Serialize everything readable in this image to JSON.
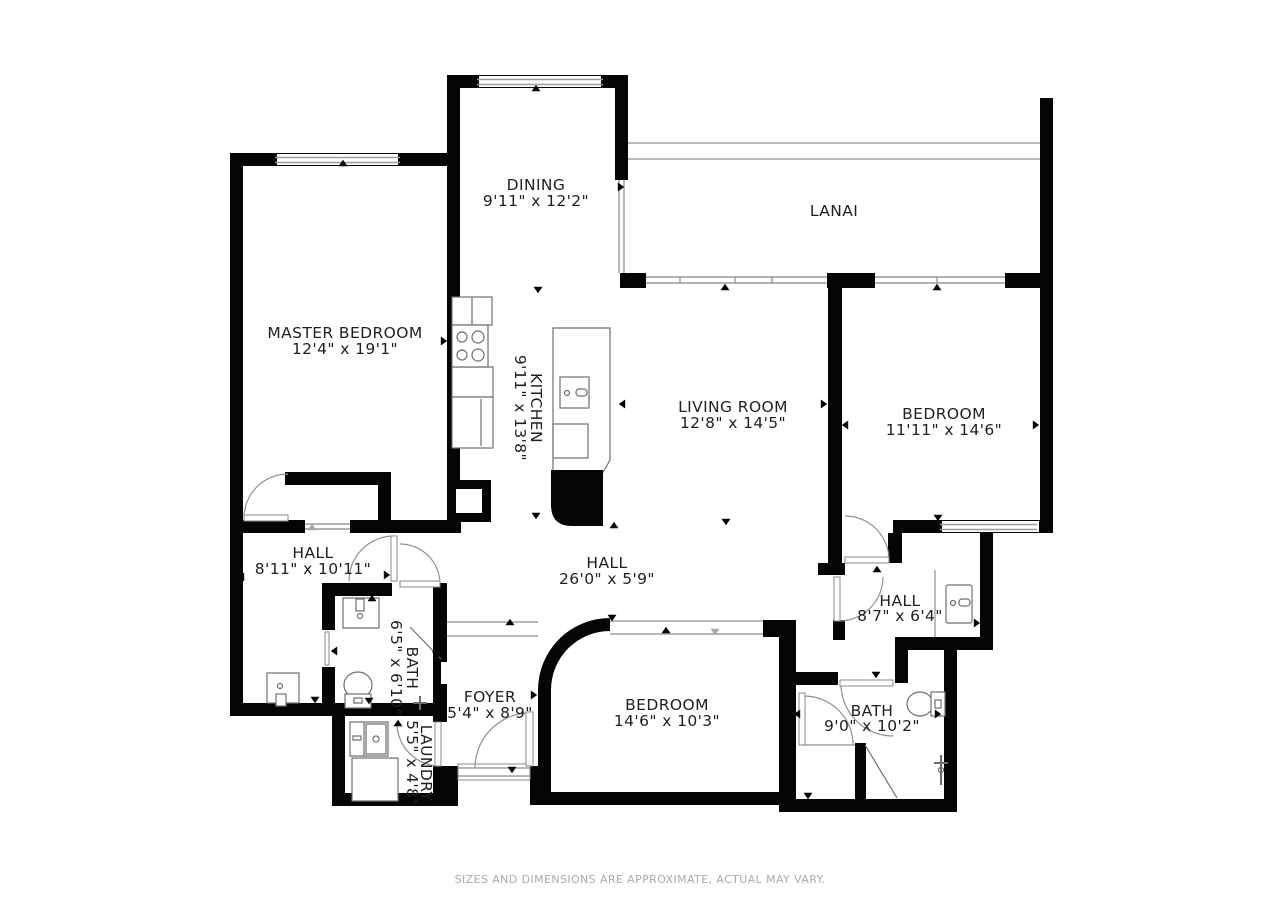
{
  "rooms": {
    "dining": {
      "name": "DINING",
      "dims": "9'11\" x 12'2\""
    },
    "lanai": {
      "name": "LANAI",
      "dims": ""
    },
    "master_bedroom": {
      "name": "MASTER BEDROOM",
      "dims": "12'4\" x 19'1\""
    },
    "kitchen": {
      "name": "KITCHEN",
      "dims": "9'11\" x 13'8\""
    },
    "living_room": {
      "name": "LIVING ROOM",
      "dims": "12'8\" x 14'5\""
    },
    "bedroom_right": {
      "name": "BEDROOM",
      "dims": "11'11\" x 14'6\""
    },
    "hall_left": {
      "name": "HALL",
      "dims": "8'11\" x 10'11\""
    },
    "hall_center": {
      "name": "HALL",
      "dims": "26'0\" x 5'9\""
    },
    "hall_right": {
      "name": "HALL",
      "dims": "8'7\" x 6'4\""
    },
    "bath_left": {
      "name": "BATH",
      "dims": "6'5\" x 6'10\""
    },
    "foyer": {
      "name": "FOYER",
      "dims": "5'4\" x 8'9\""
    },
    "bedroom_bottom": {
      "name": "BEDROOM",
      "dims": "14'6\" x 10'3\""
    },
    "bath_right": {
      "name": "BATH",
      "dims": "9'0\" x 10'2\""
    },
    "laundry": {
      "name": "LAUNDRY",
      "dims": "5'5\" x 4'8\""
    }
  },
  "footer": {
    "disclaimer": "SIZES AND DIMENSIONS ARE APPROXIMATE, ACTUAL MAY VARY."
  },
  "colors": {
    "wall": "#050505",
    "background": "#ffffff",
    "window_line": "#9b9b9b",
    "door_arc": "#909090",
    "label_text": "#1f1f1f",
    "footer_text": "#aaaaaa"
  },
  "arrows": [
    {
      "x": 536,
      "y": 88,
      "d": "up"
    },
    {
      "x": 343,
      "y": 163,
      "d": "up"
    },
    {
      "x": 452,
      "y": 187,
      "d": "left"
    },
    {
      "x": 621,
      "y": 187,
      "d": "right"
    },
    {
      "x": 237,
      "y": 341,
      "d": "left"
    },
    {
      "x": 444,
      "y": 341,
      "d": "right"
    },
    {
      "x": 725,
      "y": 287,
      "d": "up"
    },
    {
      "x": 937,
      "y": 287,
      "d": "up"
    },
    {
      "x": 622,
      "y": 404,
      "d": "left"
    },
    {
      "x": 824,
      "y": 404,
      "d": "right"
    },
    {
      "x": 726,
      "y": 522,
      "d": "down"
    },
    {
      "x": 845,
      "y": 425,
      "d": "left"
    },
    {
      "x": 1036,
      "y": 425,
      "d": "right"
    },
    {
      "x": 938,
      "y": 518,
      "d": "down"
    },
    {
      "x": 877,
      "y": 569,
      "d": "up"
    },
    {
      "x": 538,
      "y": 290,
      "d": "down"
    },
    {
      "x": 536,
      "y": 516,
      "d": "down"
    },
    {
      "x": 614,
      "y": 525,
      "d": "up"
    },
    {
      "x": 510,
      "y": 622,
      "d": "up"
    },
    {
      "x": 612,
      "y": 618,
      "d": "down"
    },
    {
      "x": 666,
      "y": 630,
      "d": "up"
    },
    {
      "x": 715,
      "y": 632,
      "d": "down",
      "c": "#a9a9a9"
    },
    {
      "x": 241,
      "y": 577,
      "d": "left"
    },
    {
      "x": 387,
      "y": 575,
      "d": "right"
    },
    {
      "x": 341,
      "y": 479,
      "d": "down"
    },
    {
      "x": 315,
      "y": 700,
      "d": "down"
    },
    {
      "x": 312,
      "y": 527,
      "d": "up",
      "c": "#a9a9a9"
    },
    {
      "x": 372,
      "y": 598,
      "d": "up"
    },
    {
      "x": 369,
      "y": 701,
      "d": "down"
    },
    {
      "x": 334,
      "y": 651,
      "d": "left"
    },
    {
      "x": 440,
      "y": 654,
      "d": "right"
    },
    {
      "x": 398,
      "y": 723,
      "d": "up"
    },
    {
      "x": 512,
      "y": 770,
      "d": "down"
    },
    {
      "x": 435,
      "y": 652,
      "d": "left"
    },
    {
      "x": 534,
      "y": 695,
      "d": "right"
    },
    {
      "x": 783,
      "y": 712,
      "d": "left"
    },
    {
      "x": 663,
      "y": 797,
      "d": "down"
    },
    {
      "x": 977,
      "y": 623,
      "d": "right"
    },
    {
      "x": 797,
      "y": 714,
      "d": "left"
    },
    {
      "x": 938,
      "y": 714,
      "d": "right"
    },
    {
      "x": 876,
      "y": 675,
      "d": "down"
    },
    {
      "x": 808,
      "y": 796,
      "d": "down"
    }
  ]
}
